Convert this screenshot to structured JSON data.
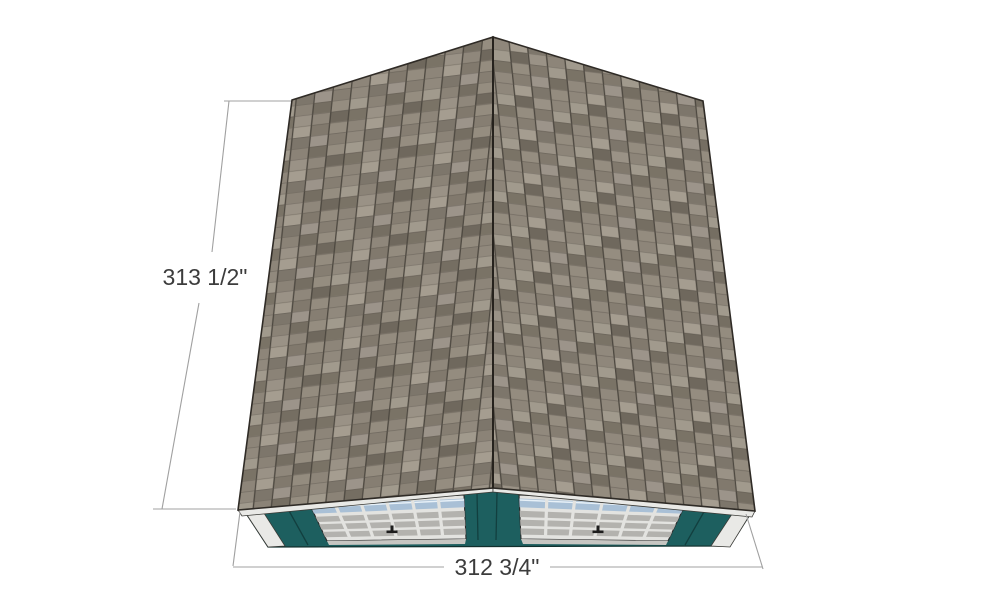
{
  "scene": {
    "description": "3D model viewport of a gable shed roof covered in asphalt shingles, viewed from a high front angle, with teal siding and two white garage doors visible below the eaves",
    "background": "#ffffff"
  },
  "annotations": {
    "left_dimension": "313 1/2\"",
    "bottom_dimension": "312 3/4\""
  },
  "colors": {
    "shingle_base": "#8b8377",
    "shingle_light": "#a59d90",
    "shingle_dark": "#6e675c",
    "shingle_line": "#4d4840",
    "siding_teal": "#1d5f5f",
    "siding_teal_dark": "#123f3f",
    "trim_white": "#e9e9e6",
    "door_frame": "#e3e3e0",
    "door_panel_gray": "#b3b2ae",
    "window_blue": "#a9c0d6",
    "door_underline": "#c7c6c2",
    "outline": "#2f2b26",
    "dimension_line": "#a0a0a0",
    "dimension_text": "#3c3c3c"
  }
}
